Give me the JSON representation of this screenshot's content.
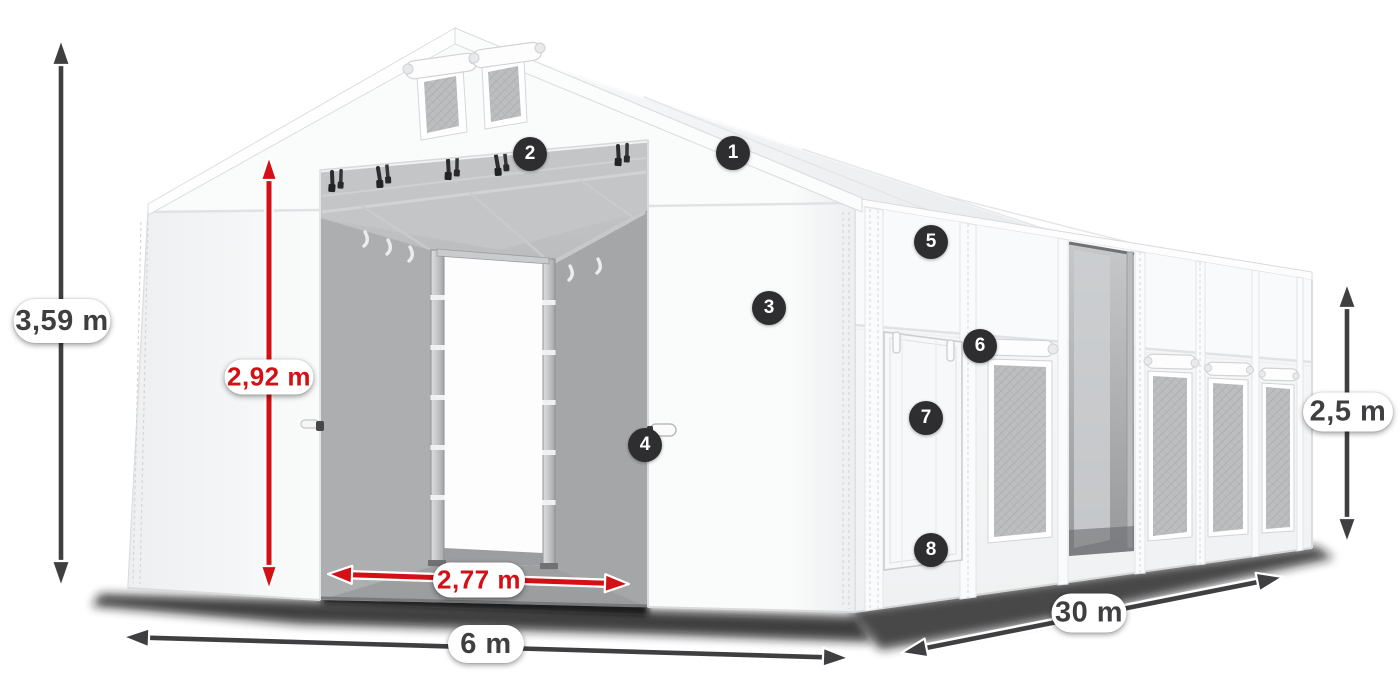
{
  "dimensions": {
    "total_height": "3,59 m",
    "door_height": "2,92 m",
    "door_width": "2,77 m",
    "front_width": "6 m",
    "length": "30 m",
    "side_height": "2,5 m"
  },
  "markers": [
    {
      "number": "1"
    },
    {
      "number": "2"
    },
    {
      "number": "3"
    },
    {
      "number": "4"
    },
    {
      "number": "5"
    },
    {
      "number": "6"
    },
    {
      "number": "7"
    },
    {
      "number": "8"
    }
  ],
  "colors": {
    "dimension_dark": "#3f3f41",
    "dimension_red": "#d21015",
    "marker_bg": "#2e2e30",
    "marker_text": "#ffffff",
    "label_bg": "#ffffff"
  }
}
